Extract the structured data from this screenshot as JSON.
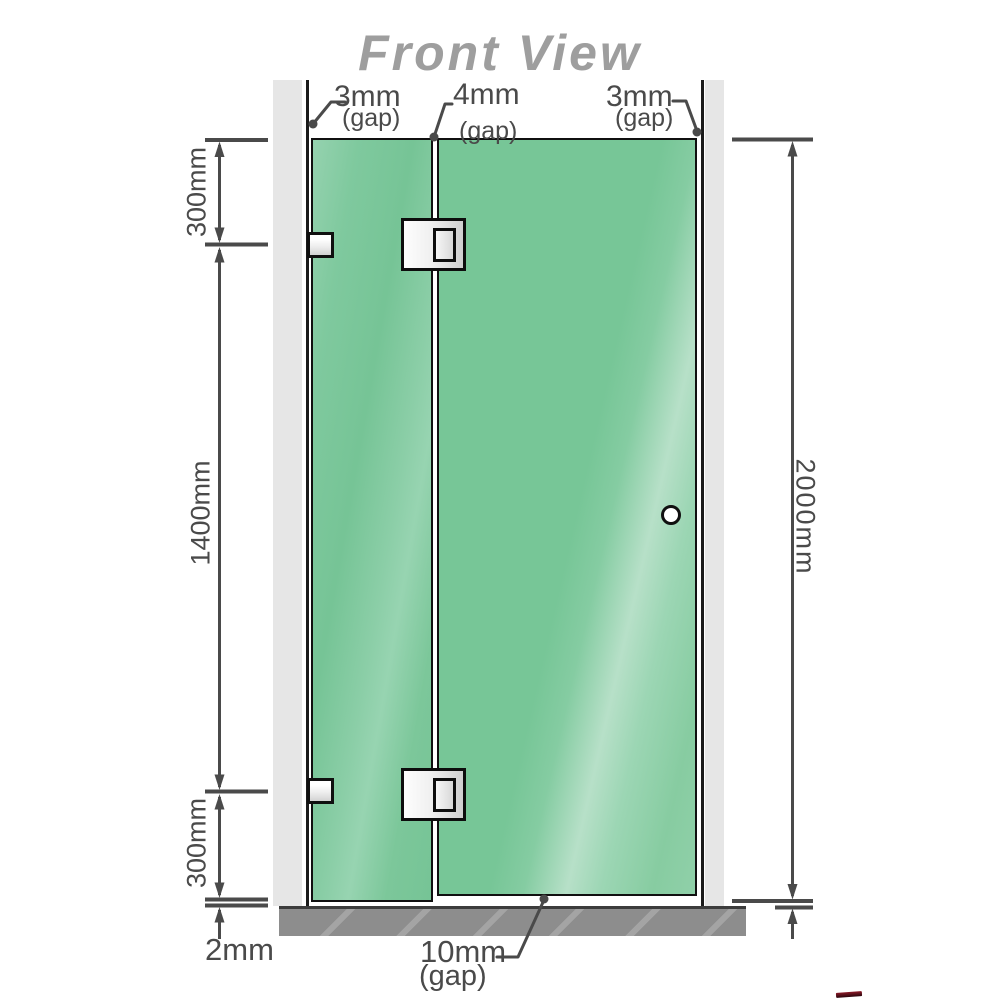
{
  "title": "Front View",
  "labels": {
    "gap_left": {
      "value": "3mm",
      "unit": "(gap)"
    },
    "gap_middle": {
      "value": "4mm",
      "unit": "(gap)"
    },
    "gap_right": {
      "value": "3mm",
      "unit": "(gap)"
    },
    "gap_bottom": {
      "value": "10mm",
      "unit": "(gap)"
    },
    "left_top_segment": "300mm",
    "left_middle_segment": "1400mm",
    "left_bottom_segment": "300mm",
    "floor_gap": "2mm",
    "total_height": "2000mm"
  },
  "colors": {
    "glass_green": "#76c496",
    "glass_highlight": "#b7e0c8",
    "wall_gray": "#e6e6e6",
    "floor_gray": "#8d8d8d",
    "outline_black": "#101010",
    "dimension_gray": "#4a4a4a",
    "title_gray": "#9e9e9e",
    "hardware_silver": "#ececec"
  }
}
